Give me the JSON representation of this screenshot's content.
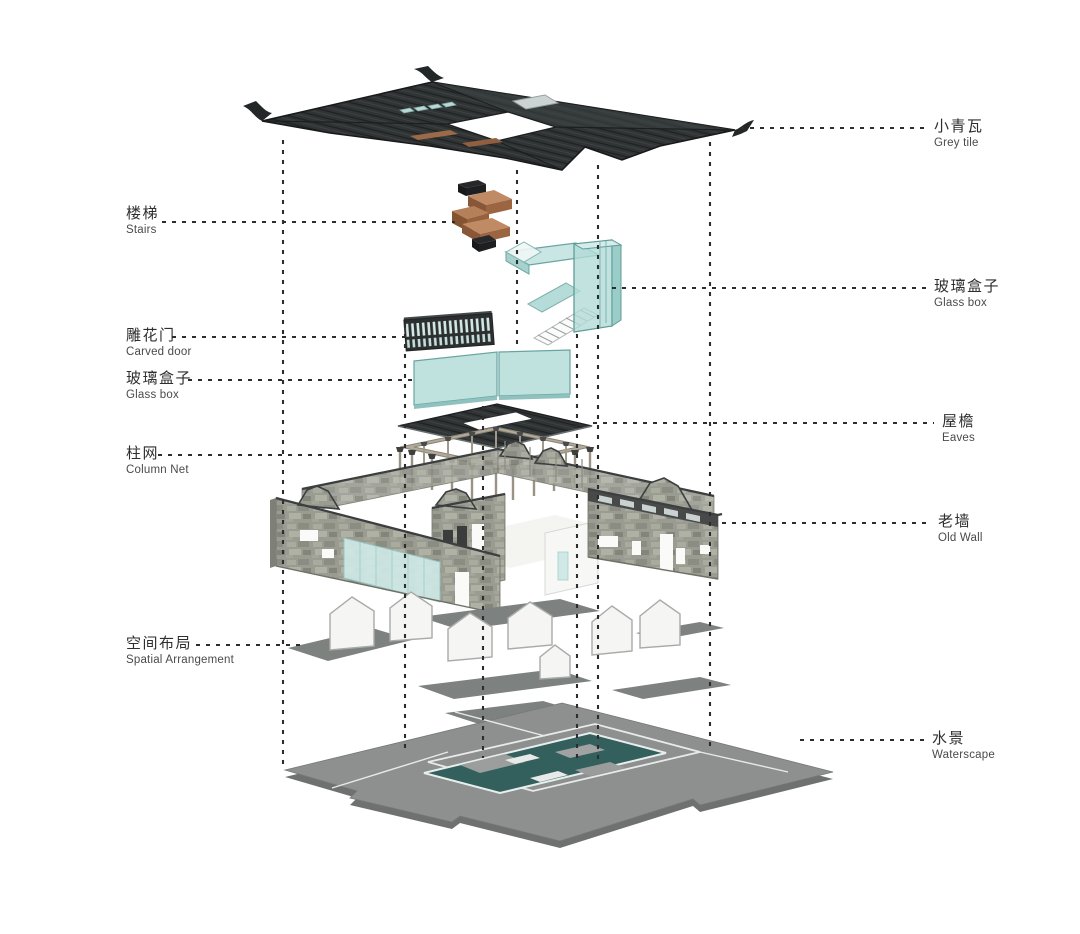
{
  "diagram_type": "exploded-axonometric-architecture",
  "labels": {
    "left": [
      {
        "zh": "楼梯",
        "en": "Stairs"
      },
      {
        "zh": "雕花门",
        "en": "Carved door"
      },
      {
        "zh": "玻璃盒子",
        "en": "Glass box"
      },
      {
        "zh": "柱网",
        "en": "Column Net"
      },
      {
        "zh": "空间布局",
        "en": "Spatial Arrangement"
      }
    ],
    "right": [
      {
        "zh": "小青瓦",
        "en": "Grey tile"
      },
      {
        "zh": "玻璃盒子",
        "en": "Glass box"
      },
      {
        "zh": "屋檐",
        "en": "Eaves"
      },
      {
        "zh": "老墙",
        "en": "Old Wall"
      },
      {
        "zh": "水景",
        "en": "Waterscape"
      }
    ]
  },
  "colors": {
    "background": "#ffffff",
    "leader_line": "#2d2d2d",
    "roof_dark": "#2f3334",
    "glass_teal": "#b2dbd7",
    "wood_brown": "#a9714c",
    "stone_grey": "#9a9b91",
    "base_grey": "#8d908e",
    "pool_teal": "#33605d",
    "label_zh": "#2e2e2e",
    "label_en": "#4a4a4a"
  }
}
